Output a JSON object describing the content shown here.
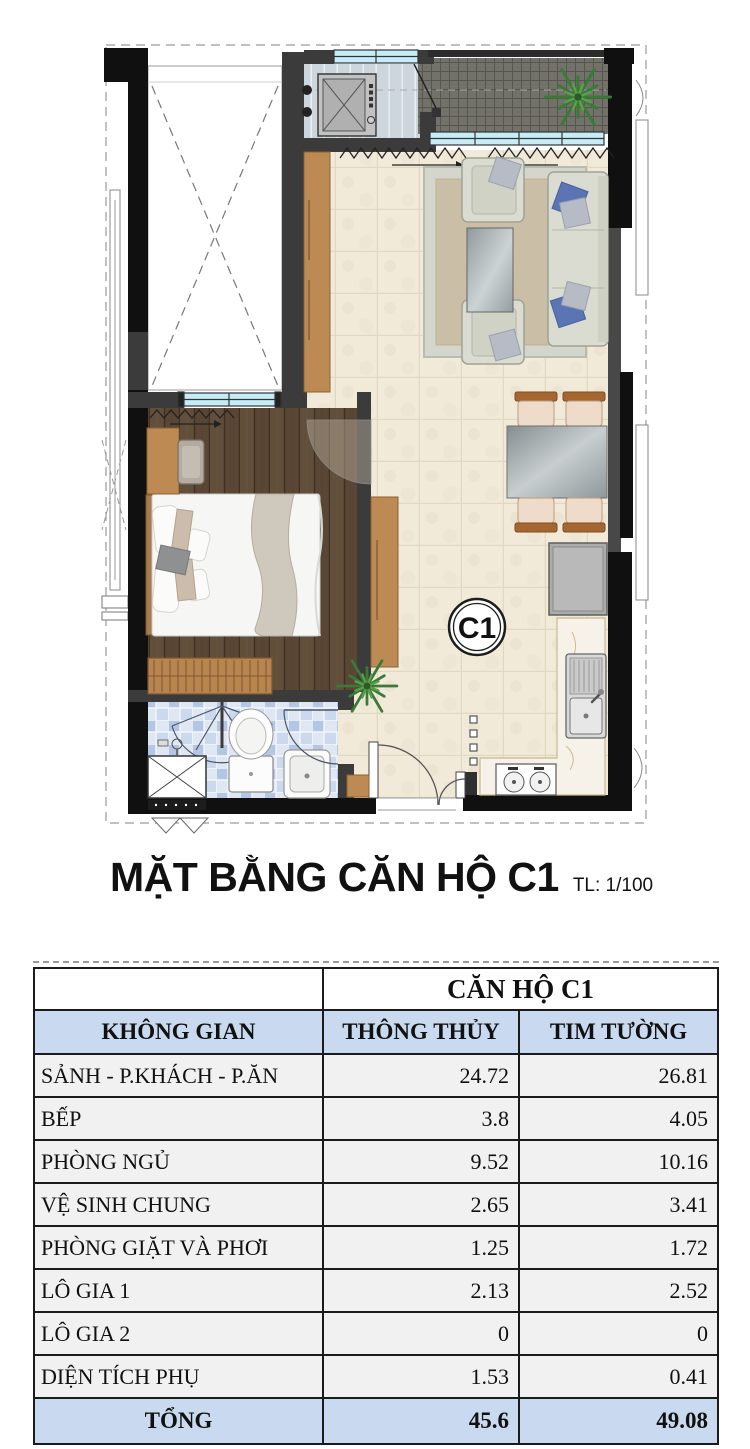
{
  "title": {
    "text": "MẶT BẰNG CĂN HỘ C1",
    "scale": "TL: 1/100"
  },
  "plan": {
    "unit_label": "C1"
  },
  "table": {
    "unit_header": "CĂN HỘ C1",
    "columns": [
      "KHÔNG GIAN",
      "THÔNG THỦY",
      "TIM TƯỜNG"
    ],
    "rows": [
      {
        "label": "SẢNH - P.KHÁCH - P.ĂN",
        "tt": "24.72",
        "tw": "26.81"
      },
      {
        "label": "BẾP",
        "tt": "3.8",
        "tw": "4.05"
      },
      {
        "label": "PHÒNG NGỦ",
        "tt": "9.52",
        "tw": "10.16"
      },
      {
        "label": "VỆ SINH CHUNG",
        "tt": "2.65",
        "tw": "3.41"
      },
      {
        "label": "PHÒNG GIẶT VÀ PHƠI",
        "tt": "1.25",
        "tw": "1.72"
      },
      {
        "label": "LÔ GIA 1",
        "tt": "2.13",
        "tw": "2.52"
      },
      {
        "label": "LÔ GIA 2",
        "tt": "0",
        "tw": "0"
      },
      {
        "label": "DIỆN TÍCH PHỤ",
        "tt": "1.53",
        "tw": "0.41"
      }
    ],
    "total": {
      "label": "TỔNG",
      "tt": "45.6",
      "tw": "49.08"
    }
  },
  "colors": {
    "wall": "#3b3b3b",
    "wall_black": "#101010",
    "window_glass": "#c5edf8",
    "wood_floor": "#5a4634",
    "tile_floor": "#f1ead9",
    "mosaic_floor": "#c9d6ec",
    "laundry_floor": "#cdd5dd",
    "balcony_floor": "#72716a",
    "cabinet_brown": "#bd8a54",
    "sofa": "#dadcd1",
    "pillow_blue": "#5b74b4",
    "header_blue": "#c9daf0",
    "row_gray": "#f1f1f1"
  }
}
